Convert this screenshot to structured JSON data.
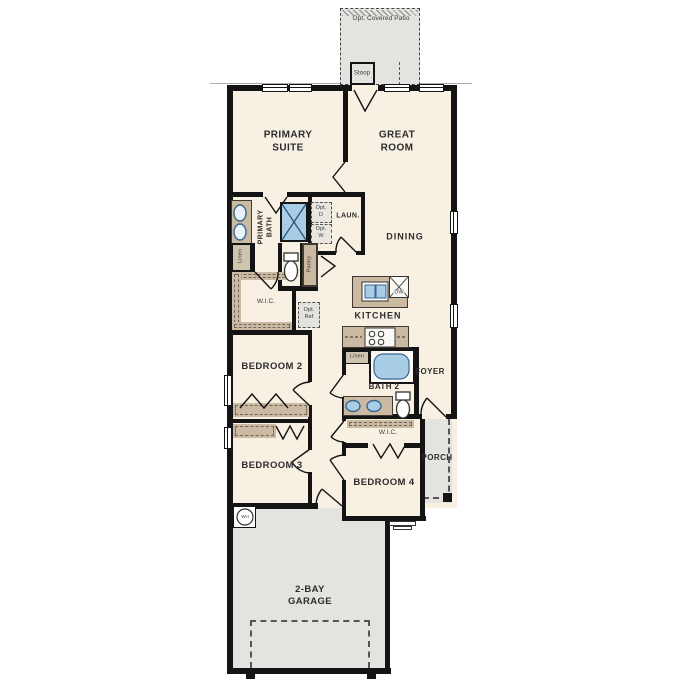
{
  "title": "Single-story home floor plan",
  "labels": {
    "patio": "Opt. Covered Patio",
    "stoop": "Stoop",
    "primary_suite": "PRIMARY SUITE",
    "great_room": "GREAT ROOM",
    "primary_bath": "PRIMARY BATH",
    "opt_d": "Opt. D",
    "opt_w": "Opt. W",
    "laundry": "LAUN.",
    "linen_primary": "Linen",
    "pantry": "Pantry",
    "wic_primary": "W.I.C.",
    "opt_ref": "Opt. Ref",
    "dining": "DINING",
    "dishwasher": "DW",
    "kitchen": "KITCHEN",
    "linen_bath2": "Linen",
    "bath2": "BATH 2",
    "foyer": "FOYER",
    "bedroom2": "BEDROOM 2",
    "bedroom3": "BEDROOM 3",
    "wic_bedroom4": "W.I.C.",
    "porch": "PORCH",
    "bedroom4": "BEDROOM 4",
    "water_heater": "WH",
    "garage": "2-BAY GARAGE"
  },
  "colors": {
    "floor": "#f8f0e3",
    "concrete": "#e4e3df",
    "cabinet": "#cbbaa1",
    "wall": "#141414",
    "fixture_fill": "#a9cde4",
    "fixture_stroke": "#38678f",
    "text": "#2d2d2d"
  }
}
